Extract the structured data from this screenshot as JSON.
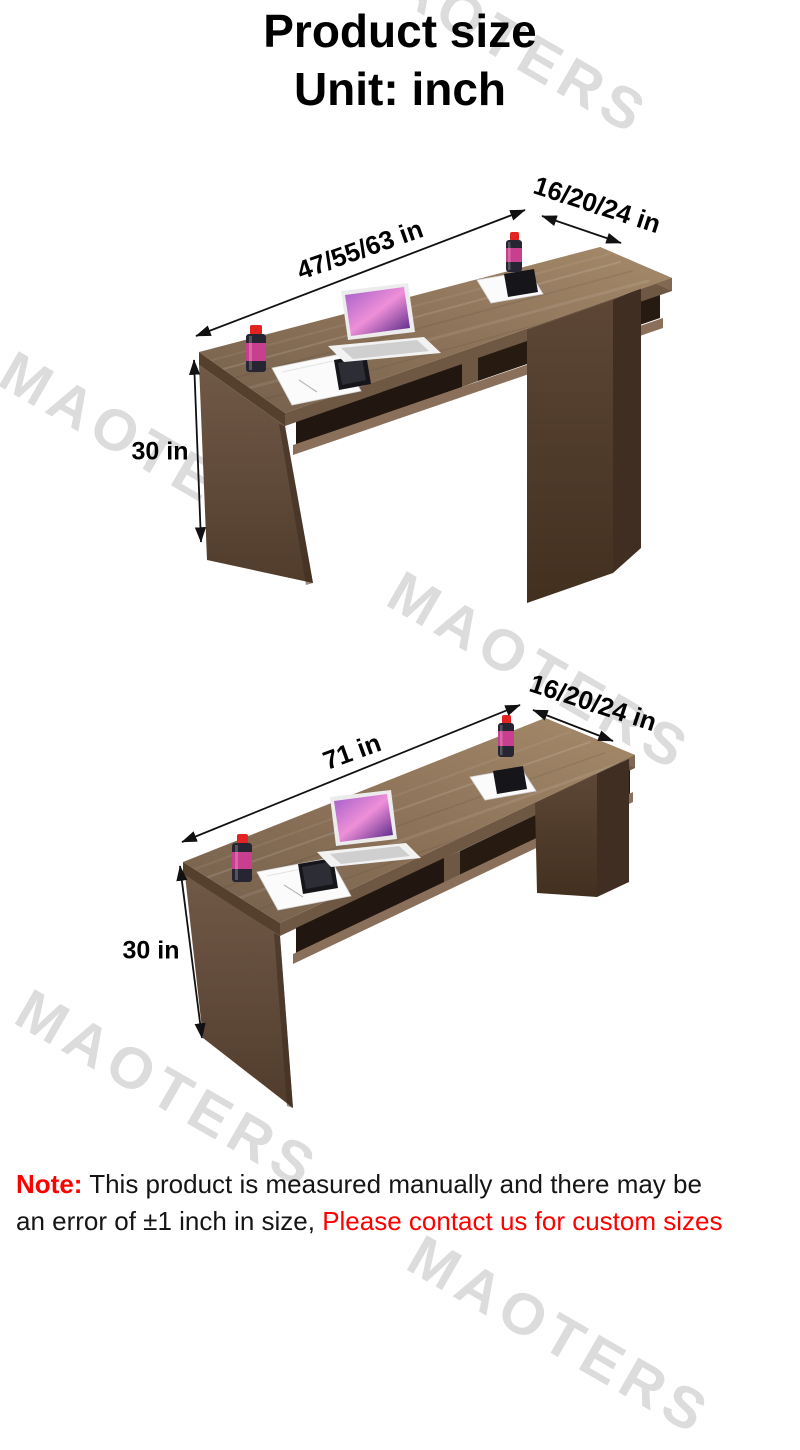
{
  "title": {
    "line1": "Product size",
    "line2": "Unit: inch"
  },
  "watermark": {
    "text": "MAOTERS"
  },
  "diagrams": [
    {
      "view": "desk-variant-sizes",
      "length_label": "47/55/63 in",
      "depth_label": "16/20/24 in",
      "height_label": "30 in"
    },
    {
      "view": "desk-71-inch",
      "length_label": "71 in",
      "depth_label": "16/20/24 in",
      "height_label": "30 in"
    }
  ],
  "note": {
    "prefix": "Note:",
    "line1_rest": "This product is measured manually and there may be",
    "line2_black": "an error of ±1 inch in size, ",
    "line2_red": "Please contact us for custom sizes"
  },
  "colors": {
    "accent_red": "#ff0000",
    "text": "#000000",
    "watermark": "#dcdcdc",
    "wood_top": "#8d7359",
    "wood_dark": "#42301f"
  }
}
